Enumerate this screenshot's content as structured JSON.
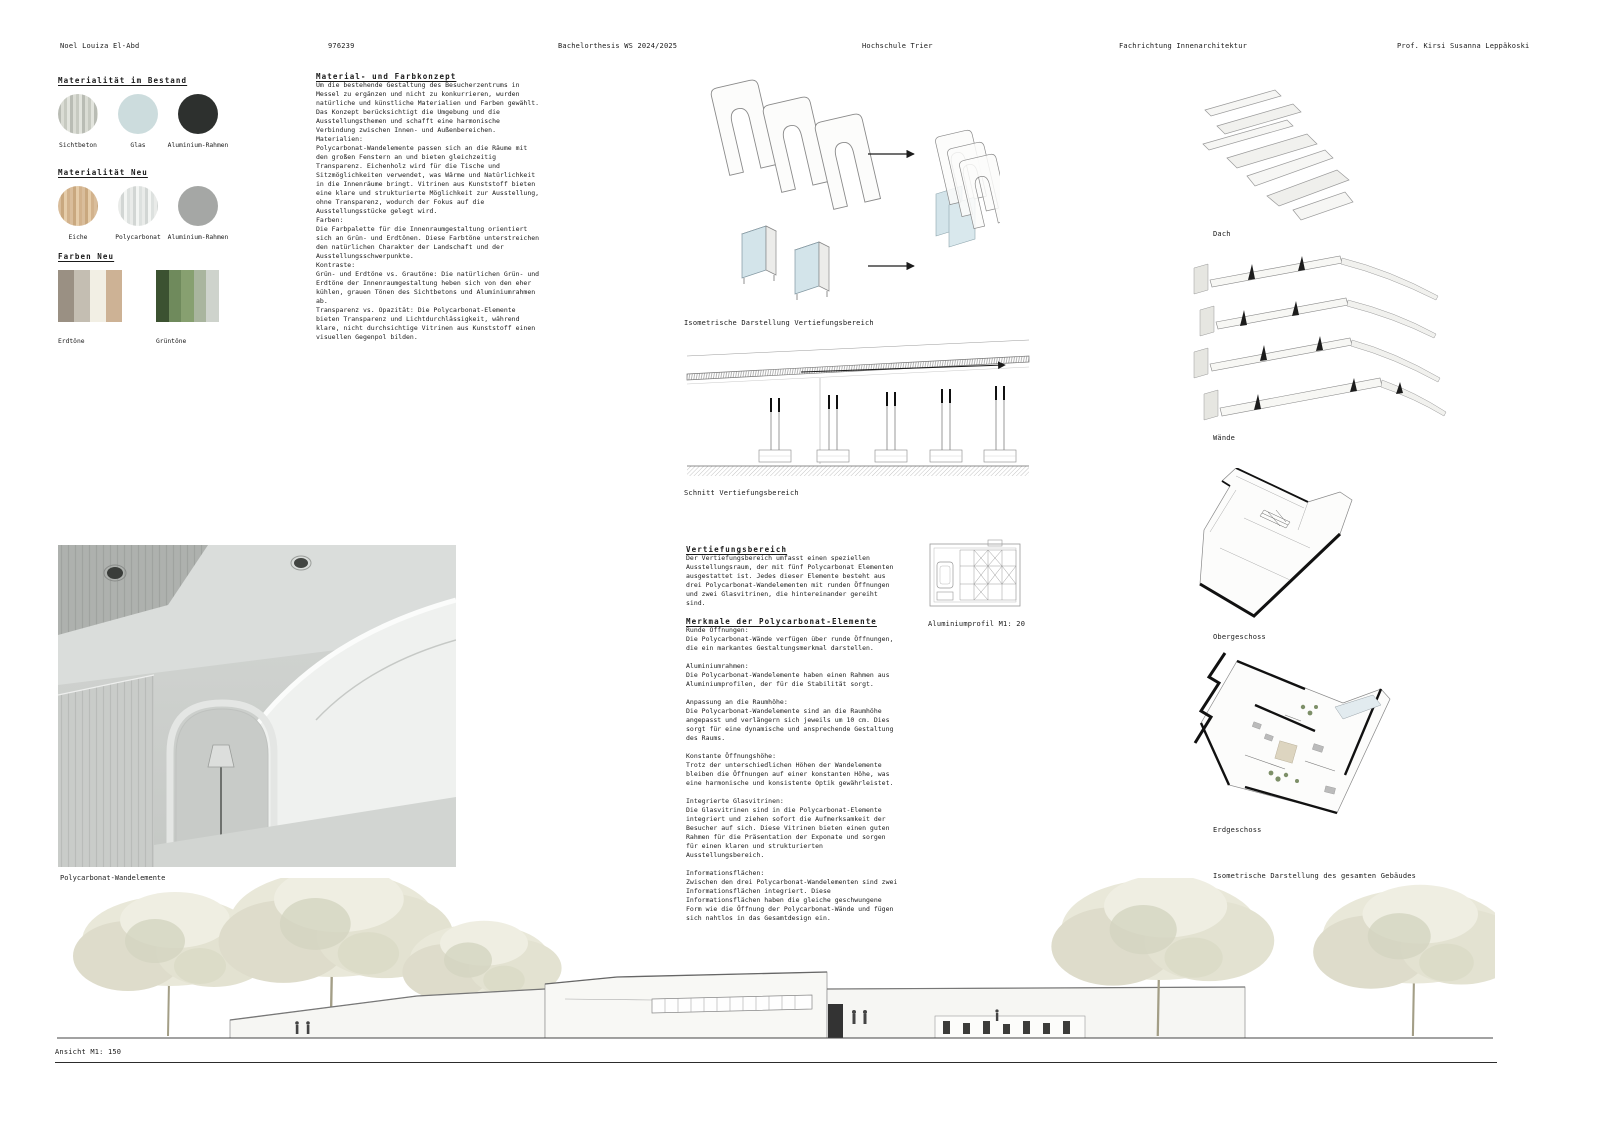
{
  "header": {
    "author": "Noel Louiza El-Abd",
    "matriculation": "976239",
    "thesis": "Bachelorthesis WS 2024/2025",
    "school": "Hochschule Trier",
    "department": "Fachrichtung Innenarchitektur",
    "professor": "Prof. Kirsi Susanna Leppäkoski"
  },
  "materials": {
    "bestand_heading": "Materialität im Bestand",
    "bestand": [
      {
        "label": "Sichtbeton",
        "swatch": "sichtbeton"
      },
      {
        "label": "Glas",
        "swatch": "glas"
      },
      {
        "label": "Aluminium-Rahmen",
        "swatch": "alu_bestand"
      }
    ],
    "neu_heading": "Materialität Neu",
    "neu": [
      {
        "label": "Eiche",
        "swatch": "eiche"
      },
      {
        "label": "Polycarbonat",
        "swatch": "polycarbonat"
      },
      {
        "label": "Aluminium-Rahmen",
        "swatch": "alu_neu"
      }
    ],
    "farben_heading": "Farben Neu",
    "swatches": {
      "sichtbeton": {
        "type": "stripes",
        "colors": [
          "#b9bcb4",
          "#dadcd4",
          "#c7cac1",
          "#e2e4dd"
        ]
      },
      "glas": {
        "type": "solid",
        "colors": [
          "#ccdcdd"
        ]
      },
      "alu_bestand": {
        "type": "solid",
        "colors": [
          "#2d302e"
        ]
      },
      "eiche": {
        "type": "stripes",
        "colors": [
          "#d9bd9b",
          "#c9a87f",
          "#e5cca9",
          "#d2b28c"
        ]
      },
      "polycarbonat": {
        "type": "stripes",
        "colors": [
          "#e9ebe9",
          "#d2d6d4",
          "#f3f5f3",
          "#dde1df"
        ]
      },
      "alu_neu": {
        "type": "solid",
        "colors": [
          "#a5a7a5"
        ]
      }
    },
    "palettes": [
      {
        "label": "Erdtöne",
        "colors": [
          "#9a9083",
          "#c4beb2",
          "#f2efe4",
          "#cdb295"
        ]
      },
      {
        "label": "Grüntöne",
        "colors": [
          "#3c5231",
          "#6f8a5c",
          "#87a070",
          "#a9b59e",
          "#ced3cc"
        ]
      }
    ]
  },
  "concept": {
    "heading": "Material- und Farbkonzept",
    "intro": "Um die bestehende Gestaltung des Besucherzentrums in Messel zu ergänzen und nicht zu konkurrieren, wurden natürliche und künstliche Materialien und Farben gewählt. Das Konzept berücksichtigt die Umgebung und die Ausstellungsthemen und schafft eine harmonische Verbindung zwischen Innen- und Außenbereichen.",
    "materialien_label": "Materialien:",
    "materialien": "Polycarbonat-Wandelemente passen sich an die Räume mit den großen Fenstern an und bieten gleichzeitig Transparenz. Eichenholz wird für die Tische und Sitzmöglichkeiten verwendet, was Wärme und Natürlichkeit in die Innenräume bringt. Vitrinen aus Kunststoff bieten eine klare und strukturierte Möglichkeit zur Ausstellung, ohne Transparenz, wodurch der Fokus auf die Ausstellungsstücke gelegt wird.",
    "farben_label": "Farben:",
    "farben": "Die Farbpalette für die Innenraumgestaltung orientiert sich an Grün- und Erdtönen. Diese Farbtöne unterstreichen den natürlichen Charakter der Landschaft und der Ausstellungsschwerpunkte.",
    "kontraste_label": "Kontraste:",
    "kontraste1": "Grün- und Erdtöne vs. Grautöne: Die natürlichen Grün- und Erdtöne der Innenraumgestaltung heben sich von den eher kühlen, grauen Tönen des Sichtbetons und Aluminiumrahmen ab.",
    "kontraste2": "Transparenz vs. Opazität: Die Polycarbonat-Elemente bieten Transparenz und Lichtdurchlässigkeit, während klare, nicht durchsichtige Vitrinen aus Kunststoff einen visuellen Gegenpol bilden."
  },
  "vertiefung": {
    "heading": "Vertiefungsbereich",
    "intro": "Der Vertiefungsbereich umfasst einen speziellen Ausstellungsraum, der mit fünf Polycarbonat Elementen ausgestattet ist. Jedes dieser Elemente besteht aus drei Polycarbonat-Wandelementen mit runden Öffnungen und zwei Glasvitrinen, die hintereinander gereiht sind.",
    "merkmale_heading": "Merkmale der Polycarbonat-Elemente",
    "items": [
      {
        "label": "Runde Öffnungen:",
        "text": "Die Polycarbonat-Wände verfügen über runde Öffnungen, die ein markantes Gestaltungsmerkmal darstellen."
      },
      {
        "label": "Aluminiumrahmen:",
        "text": "Die Polycarbonat-Wandelemente haben einen Rahmen aus Aluminiumprofilen, der für die Stabilität sorgt."
      },
      {
        "label": "Anpassung an die Raumhöhe:",
        "text": "Die Polycarbonat-Wandelemente sind an die Raumhöhe angepasst und verlängern sich jeweils um 10 cm. Dies sorgt für eine dynamische und ansprechende Gestaltung des Raums."
      },
      {
        "label": "Konstante Öffnungshöhe:",
        "text": "Trotz der unterschiedlichen Höhen der Wandelemente bleiben die Öffnungen auf einer konstanten Höhe, was eine harmonische und konsistente Optik gewährleistet."
      },
      {
        "label": "Integrierte Glasvitrinen:",
        "text": "Die Glasvitrinen sind in die Polycarbonat-Elemente integriert und ziehen sofort die Aufmerksamkeit der Besucher auf sich. Diese Vitrinen bieten einen guten Rahmen für die Präsentation der Exponate und sorgen für einen klaren und strukturierten Ausstellungsbereich."
      },
      {
        "label": "Informationsflächen:",
        "text": "Zwischen den drei Polycarbonat-Wandelementen sind zwei Informationsflächen integriert. Diese Informationsflächen haben die gleiche geschwungene Form wie die Öffnung der Polycarbonat-Wände und fügen sich nahtlos in das Gesamtdesign ein."
      }
    ]
  },
  "captions": {
    "iso_vertiefung": "Isometrische Darstellung Vertiefungsbereich",
    "schnitt": "Schnitt Vertiefungsbereich",
    "aluprofil": "Aluminiumprofil M1: 20",
    "dach": "Dach",
    "waende": "Wände",
    "obergeschoss": "Obergeschoss",
    "erdgeschoss": "Erdgeschoss",
    "iso_gebaeude": "Isometrische Darstellung des gesamten Gebäudes",
    "photo": "Polycarbonat-Wandelemente",
    "ansicht": "Ansicht M1: 150"
  }
}
